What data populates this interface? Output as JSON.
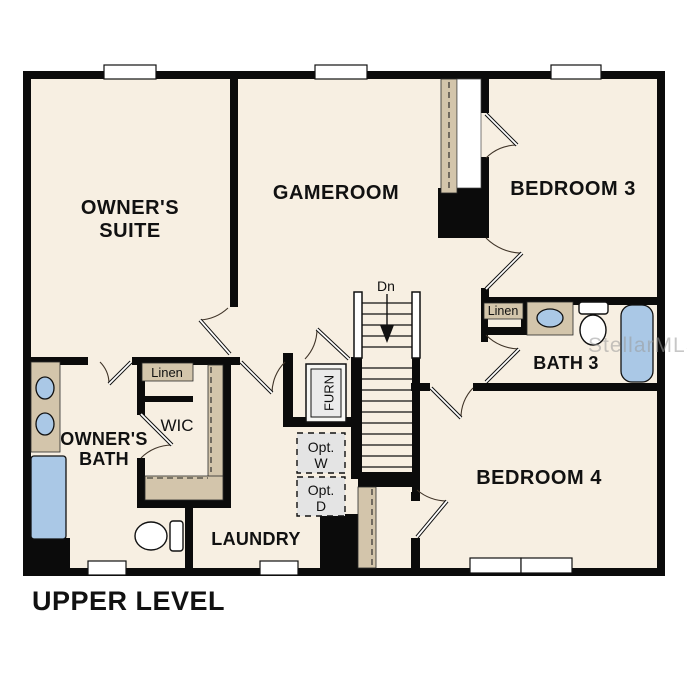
{
  "palette": {
    "background": "#ffffff",
    "floor": "#f7efe2",
    "wall": "#0b0b0b",
    "cabinet_tan": "#d3c5ab",
    "fixture_blue": "#aac8e6",
    "appliance_gray": "#e4e4e4",
    "watermark_gray": "#9b9b9b"
  },
  "plan_title": "UPPER LEVEL",
  "watermark": "StellarMLS",
  "rooms": {
    "owners_suite": {
      "line1": "OWNER'S",
      "line2": "SUITE"
    },
    "gameroom": {
      "label": "GAMEROOM"
    },
    "bedroom3": {
      "label": "BEDROOM 3"
    },
    "bedroom4": {
      "label": "BEDROOM 4"
    },
    "bath3": {
      "label": "BATH 3"
    },
    "owners_bath": {
      "line1": "OWNER'S",
      "line2": "BATH"
    },
    "wic": {
      "label": "WIC"
    },
    "laundry": {
      "label": "LAUNDRY"
    }
  },
  "closets": {
    "wic_linen": "Linen",
    "bath3_linen": "Linen"
  },
  "equipment": {
    "furnace": "FURN",
    "optional_washer": {
      "line1": "Opt.",
      "line2": "W"
    },
    "optional_dryer": {
      "line1": "Opt.",
      "line2": "D"
    }
  },
  "stairs": {
    "direction_label": "Dn"
  }
}
